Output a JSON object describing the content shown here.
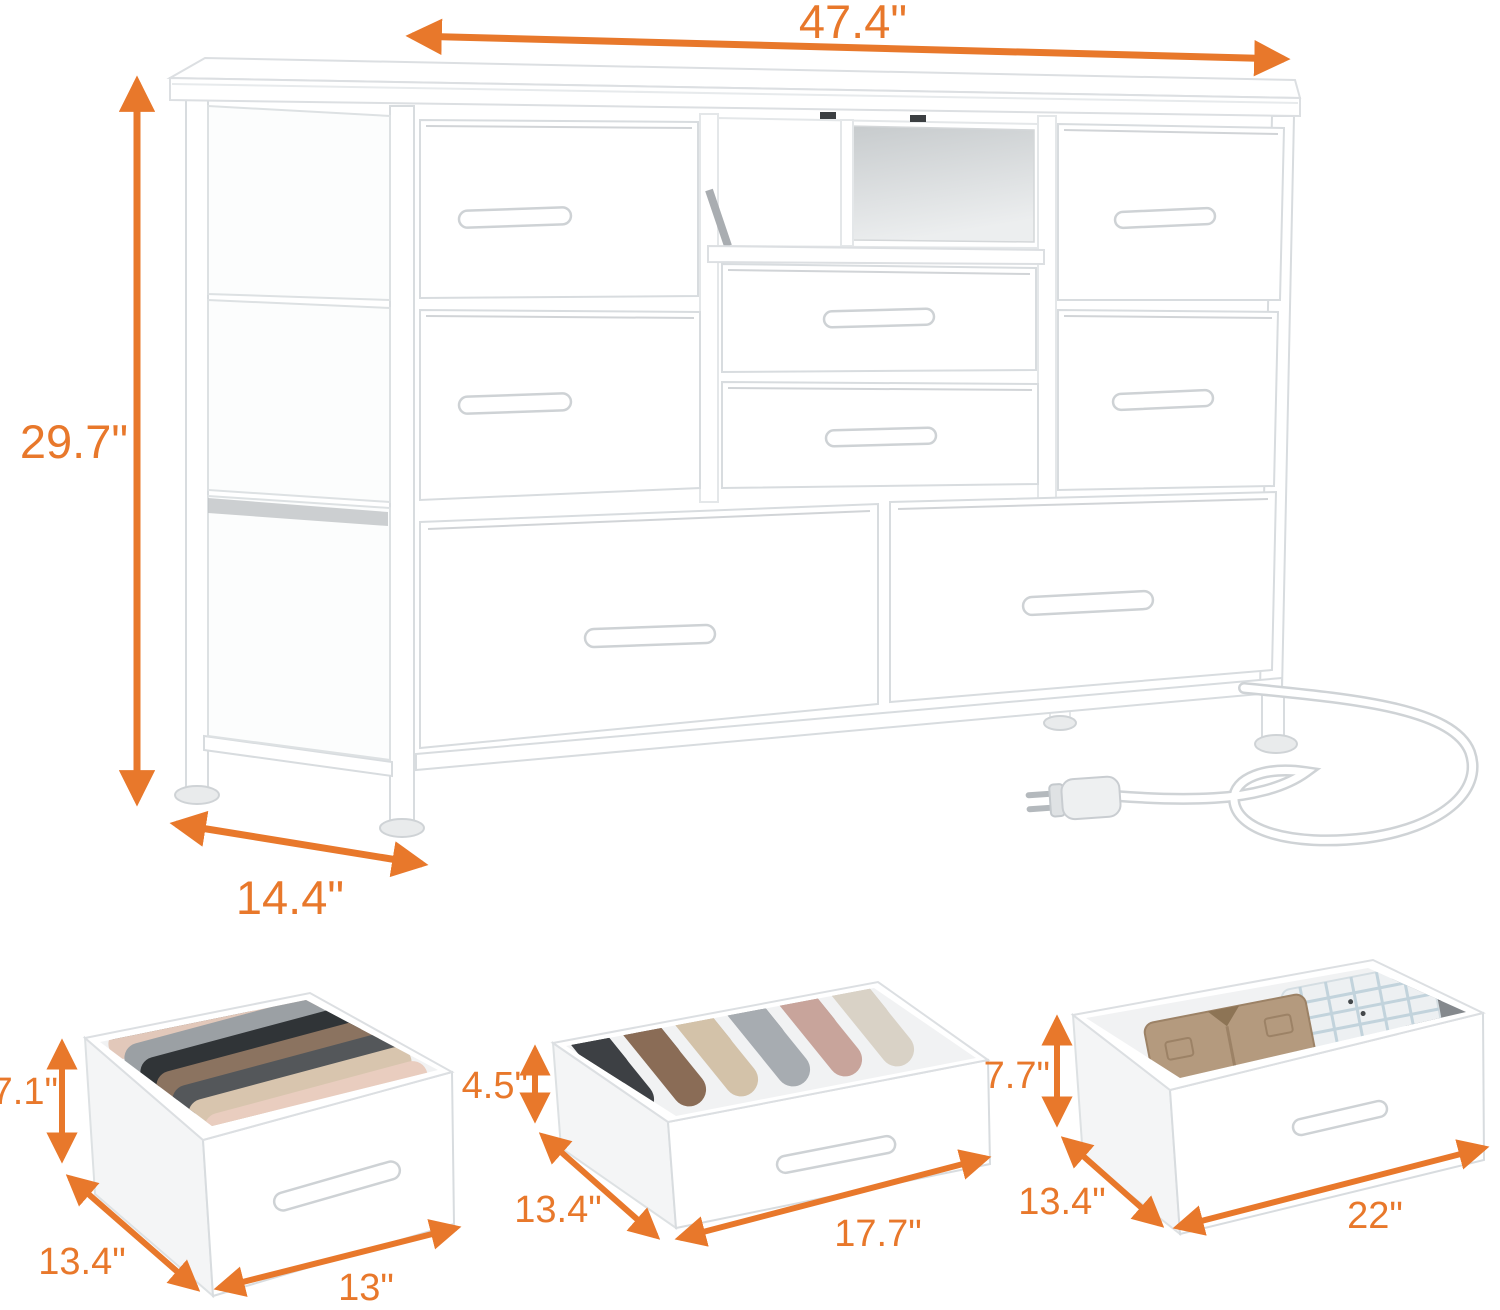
{
  "image_type": "product dimension diagram",
  "colors": {
    "accent": "#E8782B"
  },
  "main_unit": {
    "name": "white fabric dresser with 8 drawers, open media shelf and power cord",
    "width_label": "47.4\"",
    "height_label": "29.7\"",
    "depth_label": "14.4\""
  },
  "drawer_details": [
    {
      "name": "small drawer",
      "height_label": "7.1\"",
      "depth_label": "13.4\"",
      "width_label": "13\""
    },
    {
      "name": "wide shallow drawer",
      "height_label": "4.5\"",
      "depth_label": "13.4\"",
      "width_label": "17.7\""
    },
    {
      "name": "large drawer",
      "height_label": "7.7\"",
      "depth_label": "13.4\"",
      "width_label": "22\""
    }
  ]
}
